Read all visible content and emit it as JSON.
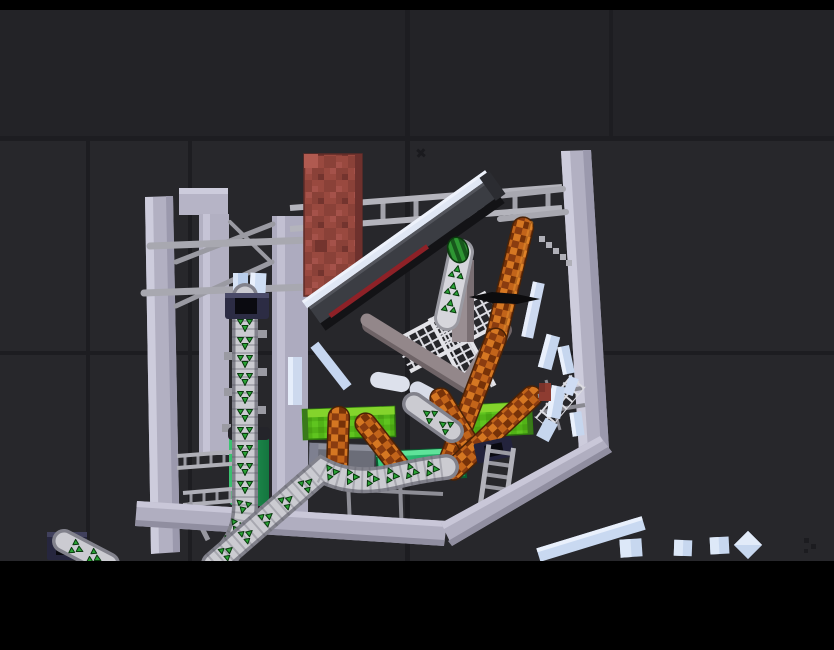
{
  "meta": {
    "app": "physics-sandbox-game",
    "scene": "collapsing-structure-playground",
    "visible_text": "none"
  },
  "viewport": {
    "width": 834,
    "height": 650,
    "letterbox_top_height": 10,
    "letterbox_bottom_start_y": 561
  },
  "grid": {
    "vertical_x": [
      88,
      190,
      407,
      611
    ],
    "horizontal_y": [
      138,
      353
    ],
    "line_color": "#1e1e22"
  },
  "palette": {
    "letterbox": "#000000",
    "background": "#27272b",
    "background_upper": "#232327",
    "grid_line": "#1d1d21",
    "beam_lavender": "#b2b0c2",
    "beam_light": "#cdccdc",
    "beam_shadow": "#908ea0",
    "rod_gray": "#a6a6ae",
    "ladder_gray": "#b4b4bc",
    "rung_gray": "#a2a2aa",
    "brick_red": "#99493f",
    "brick_dark": "#7c3a33",
    "slab_body": "#3b3d43",
    "slab_ice": "#e0e7f4",
    "slab_red": "#8e2127",
    "slab_black": "#131316",
    "taupe": "#93878a",
    "taupe_dark": "#6e6366",
    "truss_white": "#dcdce2",
    "belt_track": "#cbcbd1",
    "belt_edge": "#82828c",
    "arrow_green": "#2aa435",
    "arrow_outline": "#0a3a0f",
    "socket_navy": "#2c2c44",
    "cylinder_green": "#2fae63",
    "bar_green": "#52b317",
    "bar_green_light": "#84d42c",
    "conveyor_emerald": "#2bbf72",
    "orange": "#c2641a",
    "orange_dark": "#8a3c10",
    "glass_blue": "#c7d7ef",
    "glass_light": "#e9f0fc",
    "blade_black": "#0c0c0e",
    "melon_green": "#2e9633",
    "melon_dark": "#17571c",
    "box_gray": "#6b6d78"
  },
  "objects": [
    {
      "name": "left-column-a",
      "type": "girder",
      "color": "#b2b0c2"
    },
    {
      "name": "left-column-b",
      "type": "girder",
      "color": "#b2b0c2"
    },
    {
      "name": "left-column-c",
      "type": "girder",
      "color": "#b2b0c2"
    },
    {
      "name": "header-block",
      "type": "girder",
      "color": "#b2b0c2"
    },
    {
      "name": "right-tall-beam",
      "type": "girder",
      "color": "#b2b0c2"
    },
    {
      "name": "bottom-bent-beam",
      "type": "girder",
      "color": "#b0aec0"
    },
    {
      "name": "ladder-bridge",
      "type": "ladder",
      "color": "#b4b4bc"
    },
    {
      "name": "brick-block",
      "type": "brick",
      "color": "#99493f"
    },
    {
      "name": "tilted-dark-slab",
      "type": "slab",
      "color": "#3b3d43"
    },
    {
      "name": "taupe-bent-beam",
      "type": "beam",
      "color": "#93878a"
    },
    {
      "name": "white-truss",
      "type": "scaffold",
      "color": "#dcdce2"
    },
    {
      "name": "vertical-conveyor-belt",
      "type": "conveyor",
      "arrow_color": "#2aa435"
    },
    {
      "name": "lower-conveyor-belt",
      "type": "conveyor",
      "arrow_color": "#2aa435"
    },
    {
      "name": "corner-conveyor-belt",
      "type": "conveyor",
      "arrow_color": "#2aa435"
    },
    {
      "name": "tilted-conveyor-piece",
      "type": "conveyor",
      "arrow_color": "#2aa435"
    },
    {
      "name": "broken-conveyor-piece",
      "type": "conveyor",
      "arrow_color": "#2aa435"
    },
    {
      "name": "conveyor-socket-upper",
      "type": "socket",
      "color": "#2c2c44"
    },
    {
      "name": "conveyor-socket-lower",
      "type": "socket",
      "color": "#2c2c44"
    },
    {
      "name": "conveyor-socket-corner",
      "type": "socket",
      "color": "#2c2c44"
    },
    {
      "name": "green-cylinder-tank",
      "type": "barrel",
      "color": "#2fae63"
    },
    {
      "name": "green-bar-left",
      "type": "block",
      "color": "#52b317"
    },
    {
      "name": "green-bar-right",
      "type": "block",
      "color": "#52b317"
    },
    {
      "name": "emerald-conveyor-pad",
      "type": "conveyor",
      "color": "#2bbf72"
    },
    {
      "name": "gray-crate",
      "type": "box",
      "color": "#6b6d78"
    },
    {
      "name": "orange-capsule-long",
      "type": "capsule",
      "color": "#c2641a"
    },
    {
      "name": "orange-capsule-mid",
      "type": "capsule",
      "color": "#c2641a"
    },
    {
      "name": "orange-capsule-cross",
      "type": "capsule",
      "color": "#c2641a"
    },
    {
      "name": "orange-capsule-small-1",
      "type": "capsule",
      "color": "#c2641a"
    },
    {
      "name": "orange-capsule-small-2",
      "type": "capsule",
      "color": "#c2641a"
    },
    {
      "name": "black-blade",
      "type": "blade",
      "color": "#0c0c0e"
    },
    {
      "name": "melon",
      "type": "melon",
      "color": "#2e9633"
    },
    {
      "name": "glass-shards",
      "type": "debris",
      "color": "#c7d7ef"
    },
    {
      "name": "glass-diamond",
      "type": "debris",
      "color": "#c7d7ef"
    },
    {
      "name": "long-glass-beam",
      "type": "debris",
      "color": "#c7d7ef"
    },
    {
      "name": "side-ladder",
      "type": "ladder",
      "color": "#b4b4bc"
    },
    {
      "name": "scaffold-rails",
      "type": "scaffold",
      "color": "#b0b0b8"
    }
  ]
}
